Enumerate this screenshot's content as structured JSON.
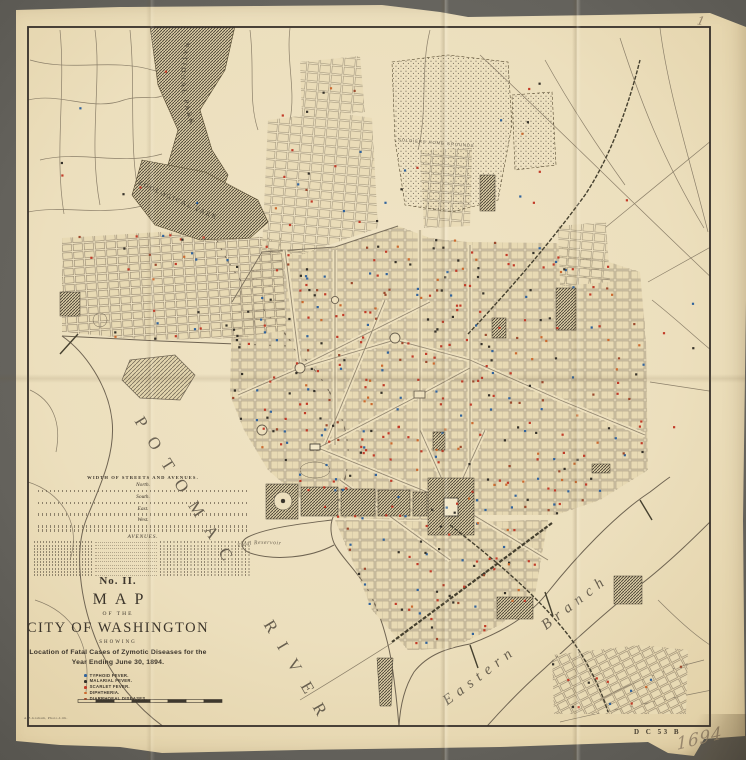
{
  "palette": {
    "paper": "#ecdfbd",
    "ink": "#3c352b",
    "street": "#8d8069",
    "park_hatch": "#4a4335",
    "water_line": "#6f6452"
  },
  "title_block": {
    "series_no": "No. II.",
    "map_word": "MAP",
    "of_the": "OF THE",
    "city": "CITY OF WASHINGTON",
    "showing": "SHOWING",
    "subtitle_line1": "Location of Fatal Cases of Zymotic Diseases for the",
    "subtitle_line2": "Year Ending June 30, 1894."
  },
  "legend": {
    "items": [
      {
        "label": "TYPHOID FEVER.",
        "color": "#31639c"
      },
      {
        "label": "MALARIAL FEVER.",
        "color": "#36322a"
      },
      {
        "label": "SCARLET FEVER.",
        "color": "#c23b28"
      },
      {
        "label": "DIPHTHERIA.",
        "color": "#cc6a2f"
      },
      {
        "label": "DIARRHOEAL DISEASES.",
        "color": "#9c4a2e"
      }
    ]
  },
  "street_table": {
    "title": "WIDTH OF STREETS AND AVENUES.",
    "sections": [
      "North.",
      "South.",
      "East.",
      "West."
    ],
    "avenues_label": "AVENUES."
  },
  "map_labels": {
    "national_park": "NATIONAL PARK",
    "zoological_park": "ZOOLOGICAL PARK",
    "soldiers_home": "SOLDIERS HOME GROUNDS",
    "potomac_river": "POTOMAC RIVER",
    "tidal_reservoir": "Tidal Reservoir",
    "eastern_branch": "Eastern Branch"
  },
  "footer": {
    "stamp": "D C 53 B",
    "handwritten_number": "1694",
    "handwritten_top": "1",
    "imprint": "A.B.Graham, Photo-Lith."
  },
  "case_dots": {
    "dot_size": 2.2,
    "colors": {
      "typhoid": "#31639c",
      "malarial": "#36322a",
      "scarlet": "#c23b28",
      "diphtheria": "#cc6a2f",
      "diarrhoeal": "#9c4a2e"
    },
    "regions": [
      {
        "name": "main-city-grid",
        "poly": [
          [
            232,
            302
          ],
          [
            262,
            252
          ],
          [
            335,
            247
          ],
          [
            398,
            226
          ],
          [
            430,
            238
          ],
          [
            468,
            242
          ],
          [
            556,
            243
          ],
          [
            590,
            256
          ],
          [
            640,
            272
          ],
          [
            646,
            340
          ],
          [
            648,
            470
          ],
          [
            600,
            500
          ],
          [
            556,
            515
          ],
          [
            470,
            515
          ],
          [
            430,
            520
          ],
          [
            335,
            518
          ],
          [
            300,
            498
          ],
          [
            268,
            470
          ],
          [
            244,
            430
          ],
          [
            230,
            395
          ]
        ],
        "counts": {
          "scarlet": 120,
          "typhoid": 70,
          "malarial": 70,
          "diphtheria": 45,
          "diarrhoeal": 40
        }
      },
      {
        "name": "georgetown",
        "poly": [
          [
            62,
            238
          ],
          [
            160,
            232
          ],
          [
            282,
            238
          ],
          [
            286,
            330
          ],
          [
            238,
            338
          ],
          [
            150,
            340
          ],
          [
            62,
            332
          ]
        ],
        "counts": {
          "scarlet": 12,
          "typhoid": 7,
          "malarial": 8,
          "diphtheria": 3,
          "diarrhoeal": 3
        }
      },
      {
        "name": "south-washington",
        "poly": [
          [
            335,
            520
          ],
          [
            465,
            522
          ],
          [
            548,
            520
          ],
          [
            535,
            595
          ],
          [
            500,
            625
          ],
          [
            452,
            648
          ],
          [
            408,
            650
          ],
          [
            372,
            610
          ],
          [
            352,
            560
          ]
        ],
        "counts": {
          "scarlet": 22,
          "typhoid": 13,
          "malarial": 15,
          "diphtheria": 6,
          "diarrhoeal": 6
        }
      },
      {
        "name": "anacostia",
        "poly": [
          [
            552,
            655
          ],
          [
            640,
            645
          ],
          [
            688,
            650
          ],
          [
            686,
            714
          ],
          [
            554,
            714
          ]
        ],
        "counts": {
          "scarlet": 5,
          "typhoid": 3,
          "malarial": 3,
          "diphtheria": 1,
          "diarrhoeal": 1
        }
      },
      {
        "name": "north-suburbs",
        "poly": [
          [
            270,
            62
          ],
          [
            420,
            58
          ],
          [
            420,
            228
          ],
          [
            270,
            228
          ]
        ],
        "counts": {
          "scarlet": 8,
          "typhoid": 5,
          "malarial": 5,
          "diphtheria": 2,
          "diarrhoeal": 2
        }
      },
      {
        "name": "west-outskirts",
        "poly": [
          [
            60,
            60
          ],
          [
            220,
            60
          ],
          [
            220,
            220
          ],
          [
            60,
            220
          ]
        ],
        "counts": {
          "scarlet": 3,
          "typhoid": 2,
          "malarial": 2,
          "diphtheria": 0,
          "diarrhoeal": 0
        }
      },
      {
        "name": "northeast-outskirts",
        "poly": [
          [
            500,
            80
          ],
          [
            640,
            80
          ],
          [
            640,
            210
          ],
          [
            500,
            210
          ]
        ],
        "counts": {
          "scarlet": 4,
          "typhoid": 2,
          "malarial": 2,
          "diphtheria": 1,
          "diarrhoeal": 0
        }
      },
      {
        "name": "east-outskirts",
        "poly": [
          [
            650,
            300
          ],
          [
            712,
            300
          ],
          [
            712,
            430
          ],
          [
            650,
            430
          ]
        ],
        "counts": {
          "scarlet": 2,
          "typhoid": 1,
          "malarial": 1,
          "diphtheria": 0,
          "diarrhoeal": 0
        }
      }
    ]
  }
}
